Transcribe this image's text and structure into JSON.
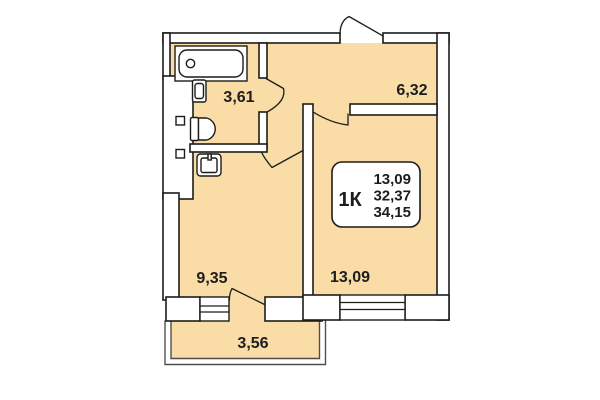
{
  "plan": {
    "unit_type_label": "1К",
    "info_card": {
      "room_area": "13,09",
      "living_total_area": "32,37",
      "total_area": "34,15"
    },
    "room_labels": {
      "bathroom": "3,61",
      "hallway": "6,32",
      "kitchen": "9,35",
      "living_room": "13,09",
      "balcony": "3,56"
    },
    "fixtures": [
      "bathtub-icon",
      "washbasin-icon",
      "toilet-icon",
      "kitchen-sink-icon",
      "vent-shaft-icon",
      "entrance-door",
      "interior-doors",
      "windows"
    ],
    "colors": {
      "room_fill": "#f9dca6",
      "wall_fill": "#ffffff",
      "outline": "#1c1c1c",
      "balcony_outline": "#4f4f4f",
      "text": "#1d1d1d",
      "background": "#ffffff"
    }
  }
}
